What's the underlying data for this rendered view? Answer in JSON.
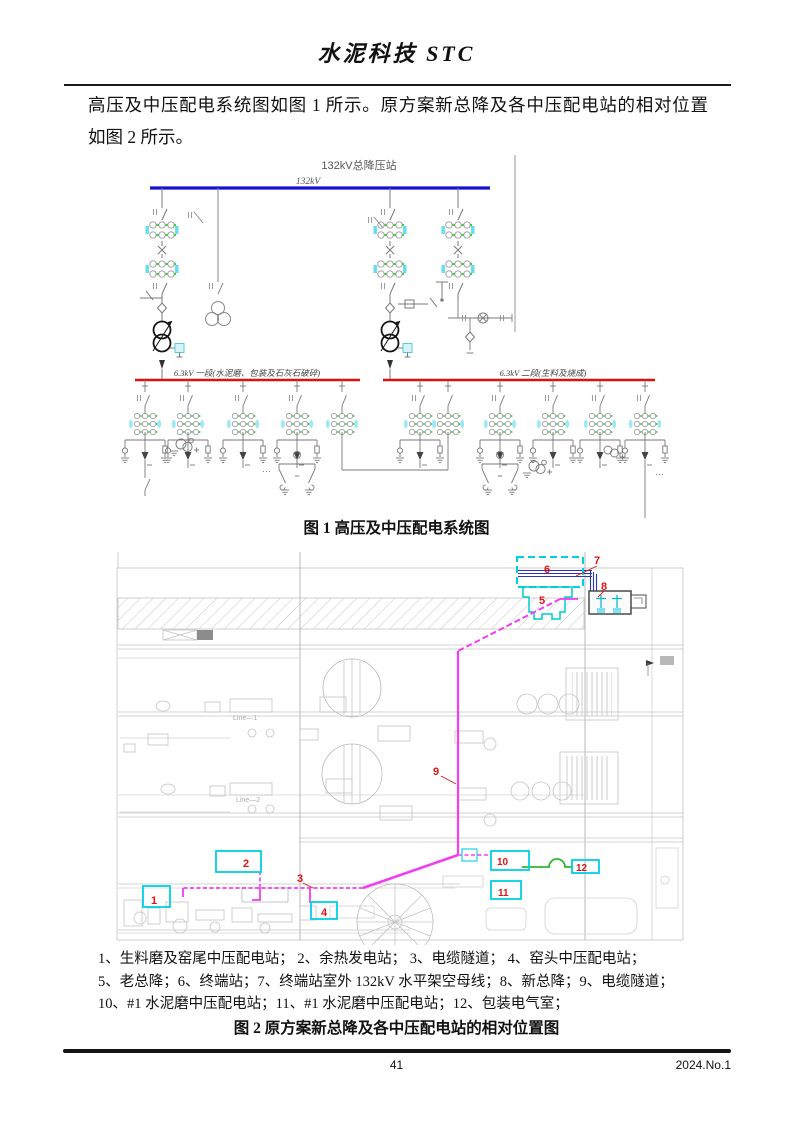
{
  "page": {
    "header_title": "水泥科技 STC",
    "body_line1": "高压及中压配电系统图如图 1 所示。原方案新总降及各中压配电站的相对位置",
    "body_line2": "如图 2 所示。",
    "footer_page_number": "41",
    "footer_issue": "2024.No.1"
  },
  "figure1": {
    "caption": "图 1 高压及中压配电系统图",
    "station_title": "132kV总降压站",
    "hv_bus_label": "132kV",
    "mv_bus1_label": "6.3kV 一段(水泥磨、包装及石灰石破碎)",
    "mv_bus2_label": "6.3kV 二段(生料及烧成)",
    "ellipsis": "⋯",
    "colors": {
      "hv_bus": "#1414cc",
      "mv_bus": "#dd1111",
      "ct_green": "#44cc44",
      "ct_cyan": "#66ddee"
    }
  },
  "figure2": {
    "caption": "图 2 原方案新总降及各中压配电站的相对位置图",
    "line1_label": "Line—1",
    "line2_label": "Line—2",
    "markers": [
      "1",
      "2",
      "3",
      "4",
      "5",
      "6",
      "7",
      "8",
      "9",
      "10",
      "11",
      "12"
    ],
    "colors": {
      "route_magenta": "#f23ef2",
      "highlight_cyan": "#00d0e6",
      "marker_red": "#e11414",
      "link_green": "#2db82d",
      "hv_blue": "#2a35bb"
    }
  },
  "legend": {
    "lines": [
      "1、生料磨及窑尾中压配电站；  2、余热发电站；  3、电缆隧道；  4、窑头中压配电站；",
      "5、老总降；6、终端站；7、终端站室外 132kV 水平架空母线；8、新总降；9、电缆隧道；",
      "10、#1 水泥磨中压配电站；11、#1 水泥磨中压配电站；12、包装电气室；"
    ]
  }
}
